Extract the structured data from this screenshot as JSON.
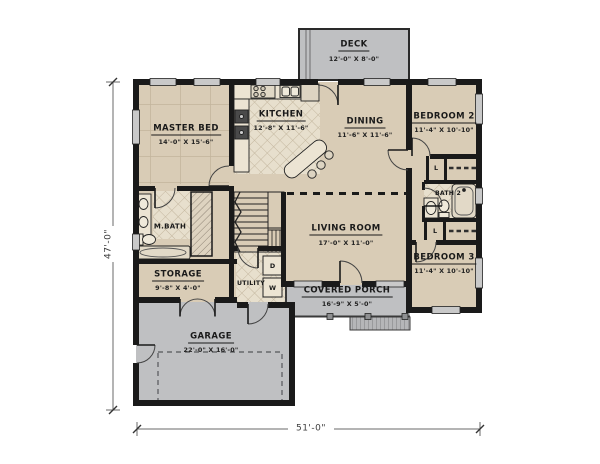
{
  "plan": {
    "overall_width": "51'-0\"",
    "overall_height": "47'-0\"",
    "rooms": {
      "deck": {
        "name": "DECK",
        "dims": "12'-0\" X 8'-0\""
      },
      "master_bed": {
        "name": "MASTER BED",
        "dims": "14'-0\" X 15'-6\""
      },
      "kitchen": {
        "name": "KITCHEN",
        "dims": "12'-8\" X 11'-6\""
      },
      "dining": {
        "name": "DINING",
        "dims": "11'-6\" X 11'-6\""
      },
      "bedroom2": {
        "name": "BEDROOM 2",
        "dims": "11'-4\" X 10'-10\""
      },
      "bath2": {
        "name": "BATH 2"
      },
      "master_bath": {
        "name": "M.BATH"
      },
      "living_room": {
        "name": "LIVING ROOM",
        "dims": "17'-0\" X 11'-0\""
      },
      "storage": {
        "name": "STORAGE",
        "dims": "9'-8\" X 4'-0\""
      },
      "utility": {
        "name": "UTILITY"
      },
      "covered_porch": {
        "name": "COVERED PORCH",
        "dims": "16'-9\" X 5'-0\""
      },
      "bedroom3": {
        "name": "BEDROOM 3",
        "dims": "11'-4\" X 10'-10\""
      },
      "garage": {
        "name": "GARAGE",
        "dims": "22'-0\" X 16'-0\""
      }
    },
    "labels": {
      "washer": "W",
      "dryer": "D",
      "linen": "L"
    },
    "colors": {
      "floor": "#d9ccb6",
      "hardscape": "#bfc0c2",
      "wall": "#1a1a1a",
      "tile": "#e7dfcd"
    }
  }
}
